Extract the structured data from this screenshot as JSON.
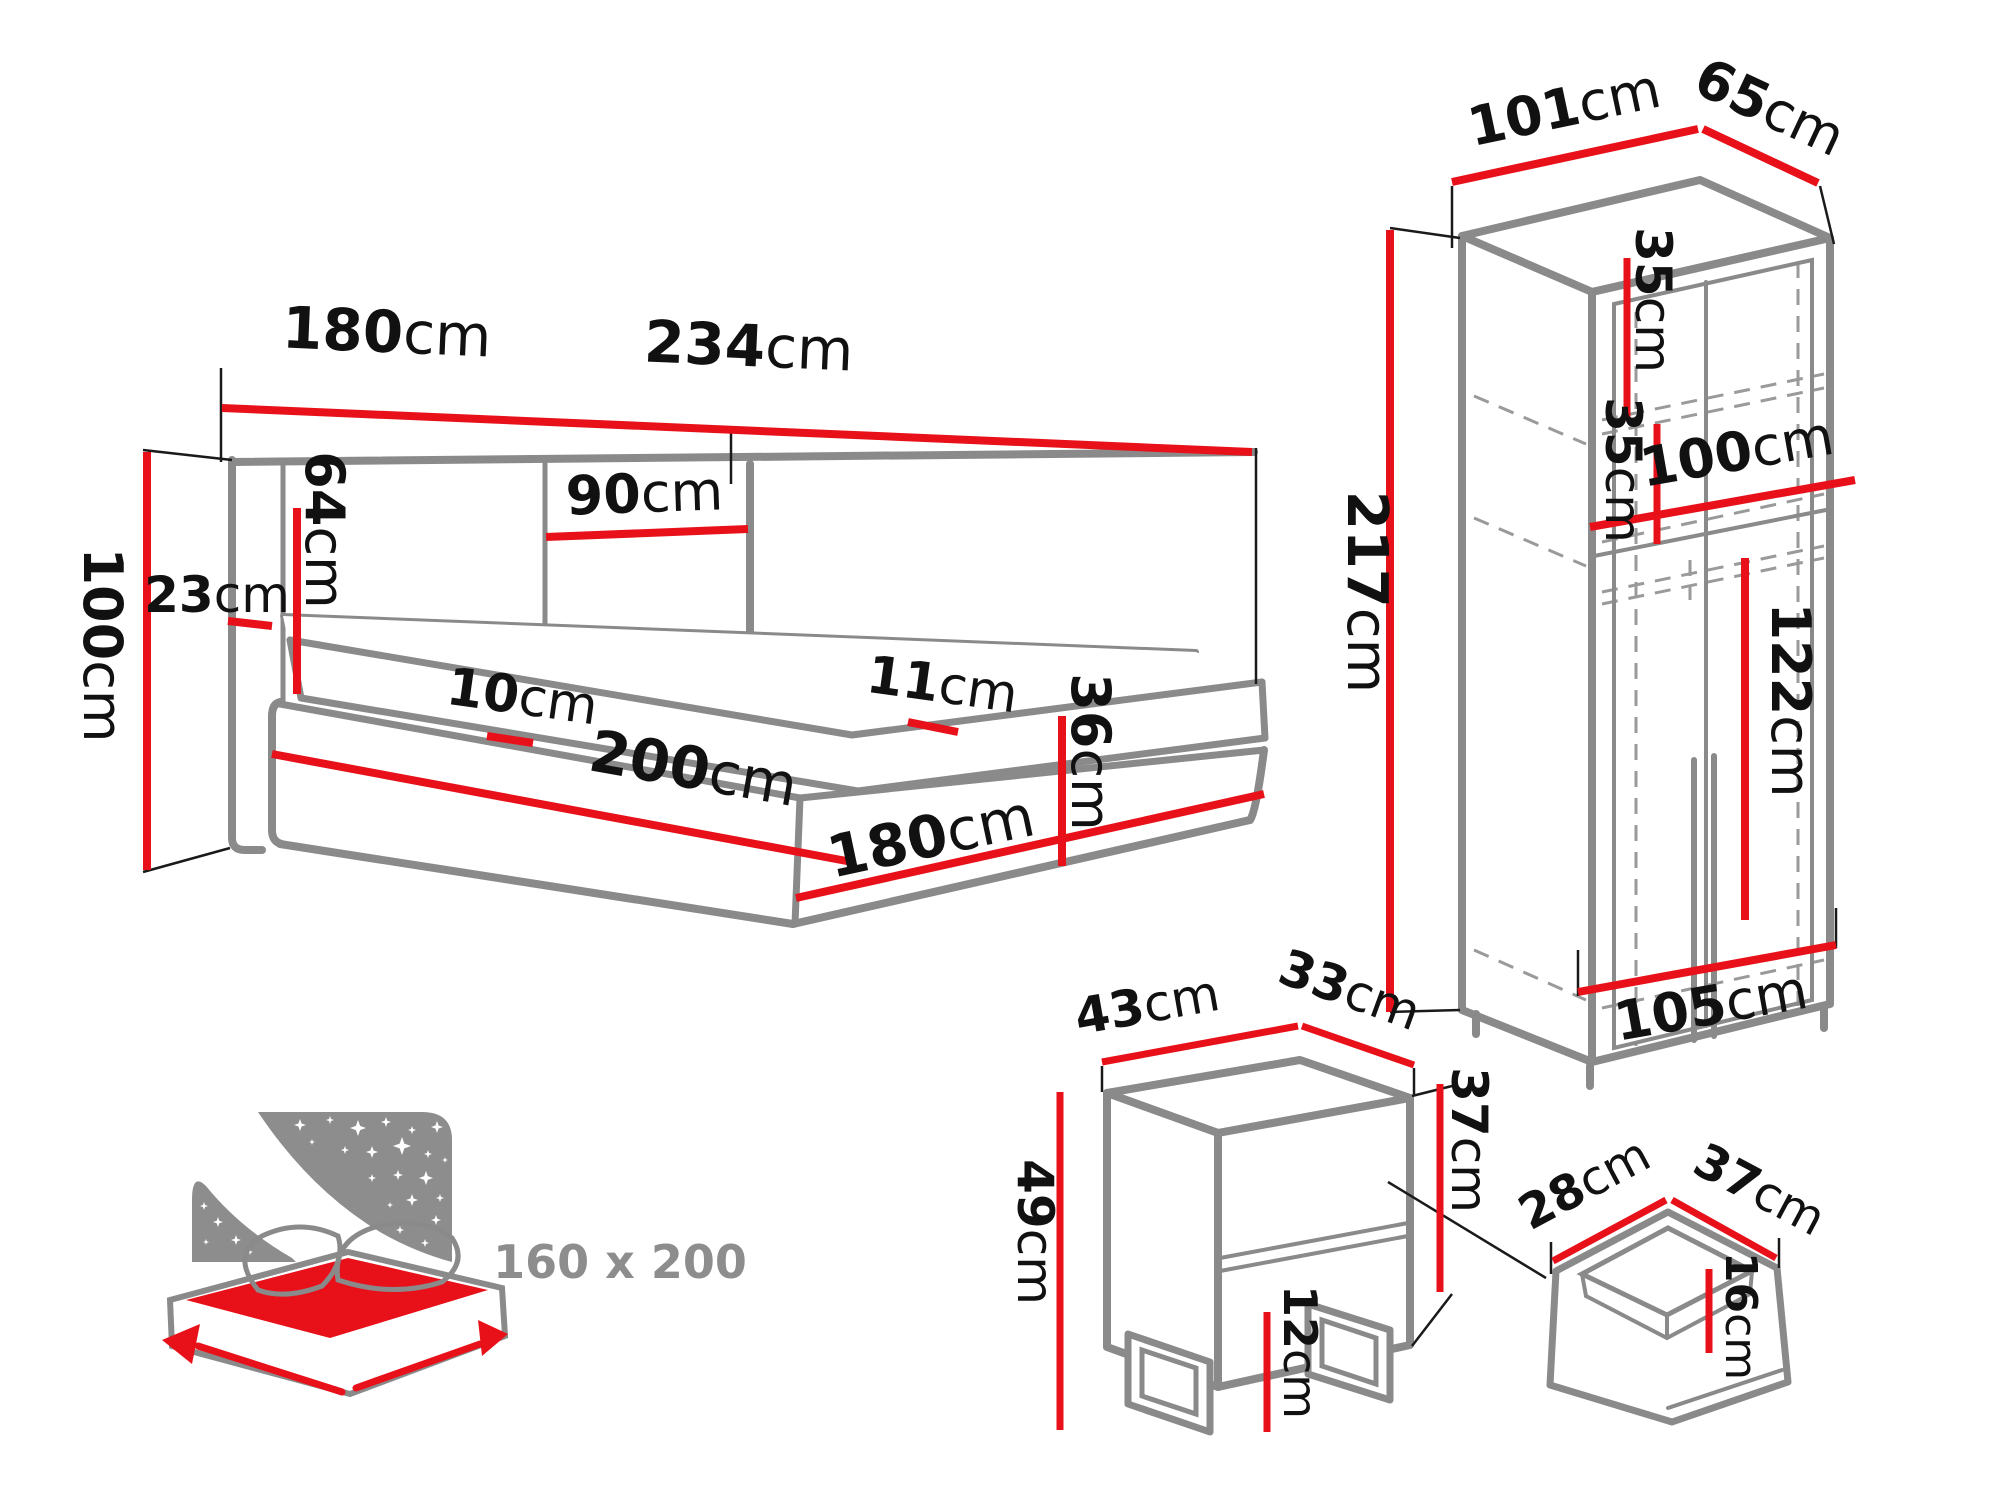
{
  "unit": "cm",
  "colors": {
    "dimension_red": "#e8111a",
    "furniture_gray": "#8a8a8a",
    "label_text": "#111111",
    "icon_gray": "#8d8d8d",
    "background": "#ffffff"
  },
  "bed": {
    "headboard_width": {
      "v": "180",
      "u": "cm"
    },
    "total_length": {
      "v": "234",
      "u": "cm"
    },
    "headboard_panel": {
      "v": "90",
      "u": "cm"
    },
    "headboard_height": {
      "v": "64",
      "u": "cm"
    },
    "side_wing": {
      "v": "23",
      "u": "cm"
    },
    "height": {
      "v": "100",
      "u": "cm"
    },
    "mattress_edge": {
      "v": "10",
      "u": "cm"
    },
    "length": {
      "v": "200",
      "u": "cm"
    },
    "top_rim": {
      "v": "11",
      "u": "cm"
    },
    "base_height": {
      "v": "36",
      "u": "cm"
    },
    "width": {
      "v": "180",
      "u": "cm"
    }
  },
  "wardrobe": {
    "top_width": {
      "v": "101",
      "u": "cm"
    },
    "top_depth": {
      "v": "65",
      "u": "cm"
    },
    "shelf_gap_1": {
      "v": "35",
      "u": "cm"
    },
    "shelf_gap_2": {
      "v": "35",
      "u": "cm"
    },
    "inner_width": {
      "v": "100",
      "u": "cm"
    },
    "height": {
      "v": "217",
      "u": "cm"
    },
    "hanging_height": {
      "v": "122",
      "u": "cm"
    },
    "bottom_width": {
      "v": "105",
      "u": "cm"
    }
  },
  "nightstand": {
    "width": {
      "v": "43",
      "u": "cm"
    },
    "depth": {
      "v": "33",
      "u": "cm"
    },
    "body_height": {
      "v": "37",
      "u": "cm"
    },
    "total_height": {
      "v": "49",
      "u": "cm"
    },
    "leg_height": {
      "v": "12",
      "u": "cm"
    }
  },
  "drawer": {
    "inner_width": {
      "v": "28",
      "u": "cm"
    },
    "inner_depth": {
      "v": "37",
      "u": "cm"
    },
    "inner_height": {
      "v": "16",
      "u": "cm"
    }
  },
  "mattress_size_icon": {
    "label": "160 x 200"
  }
}
